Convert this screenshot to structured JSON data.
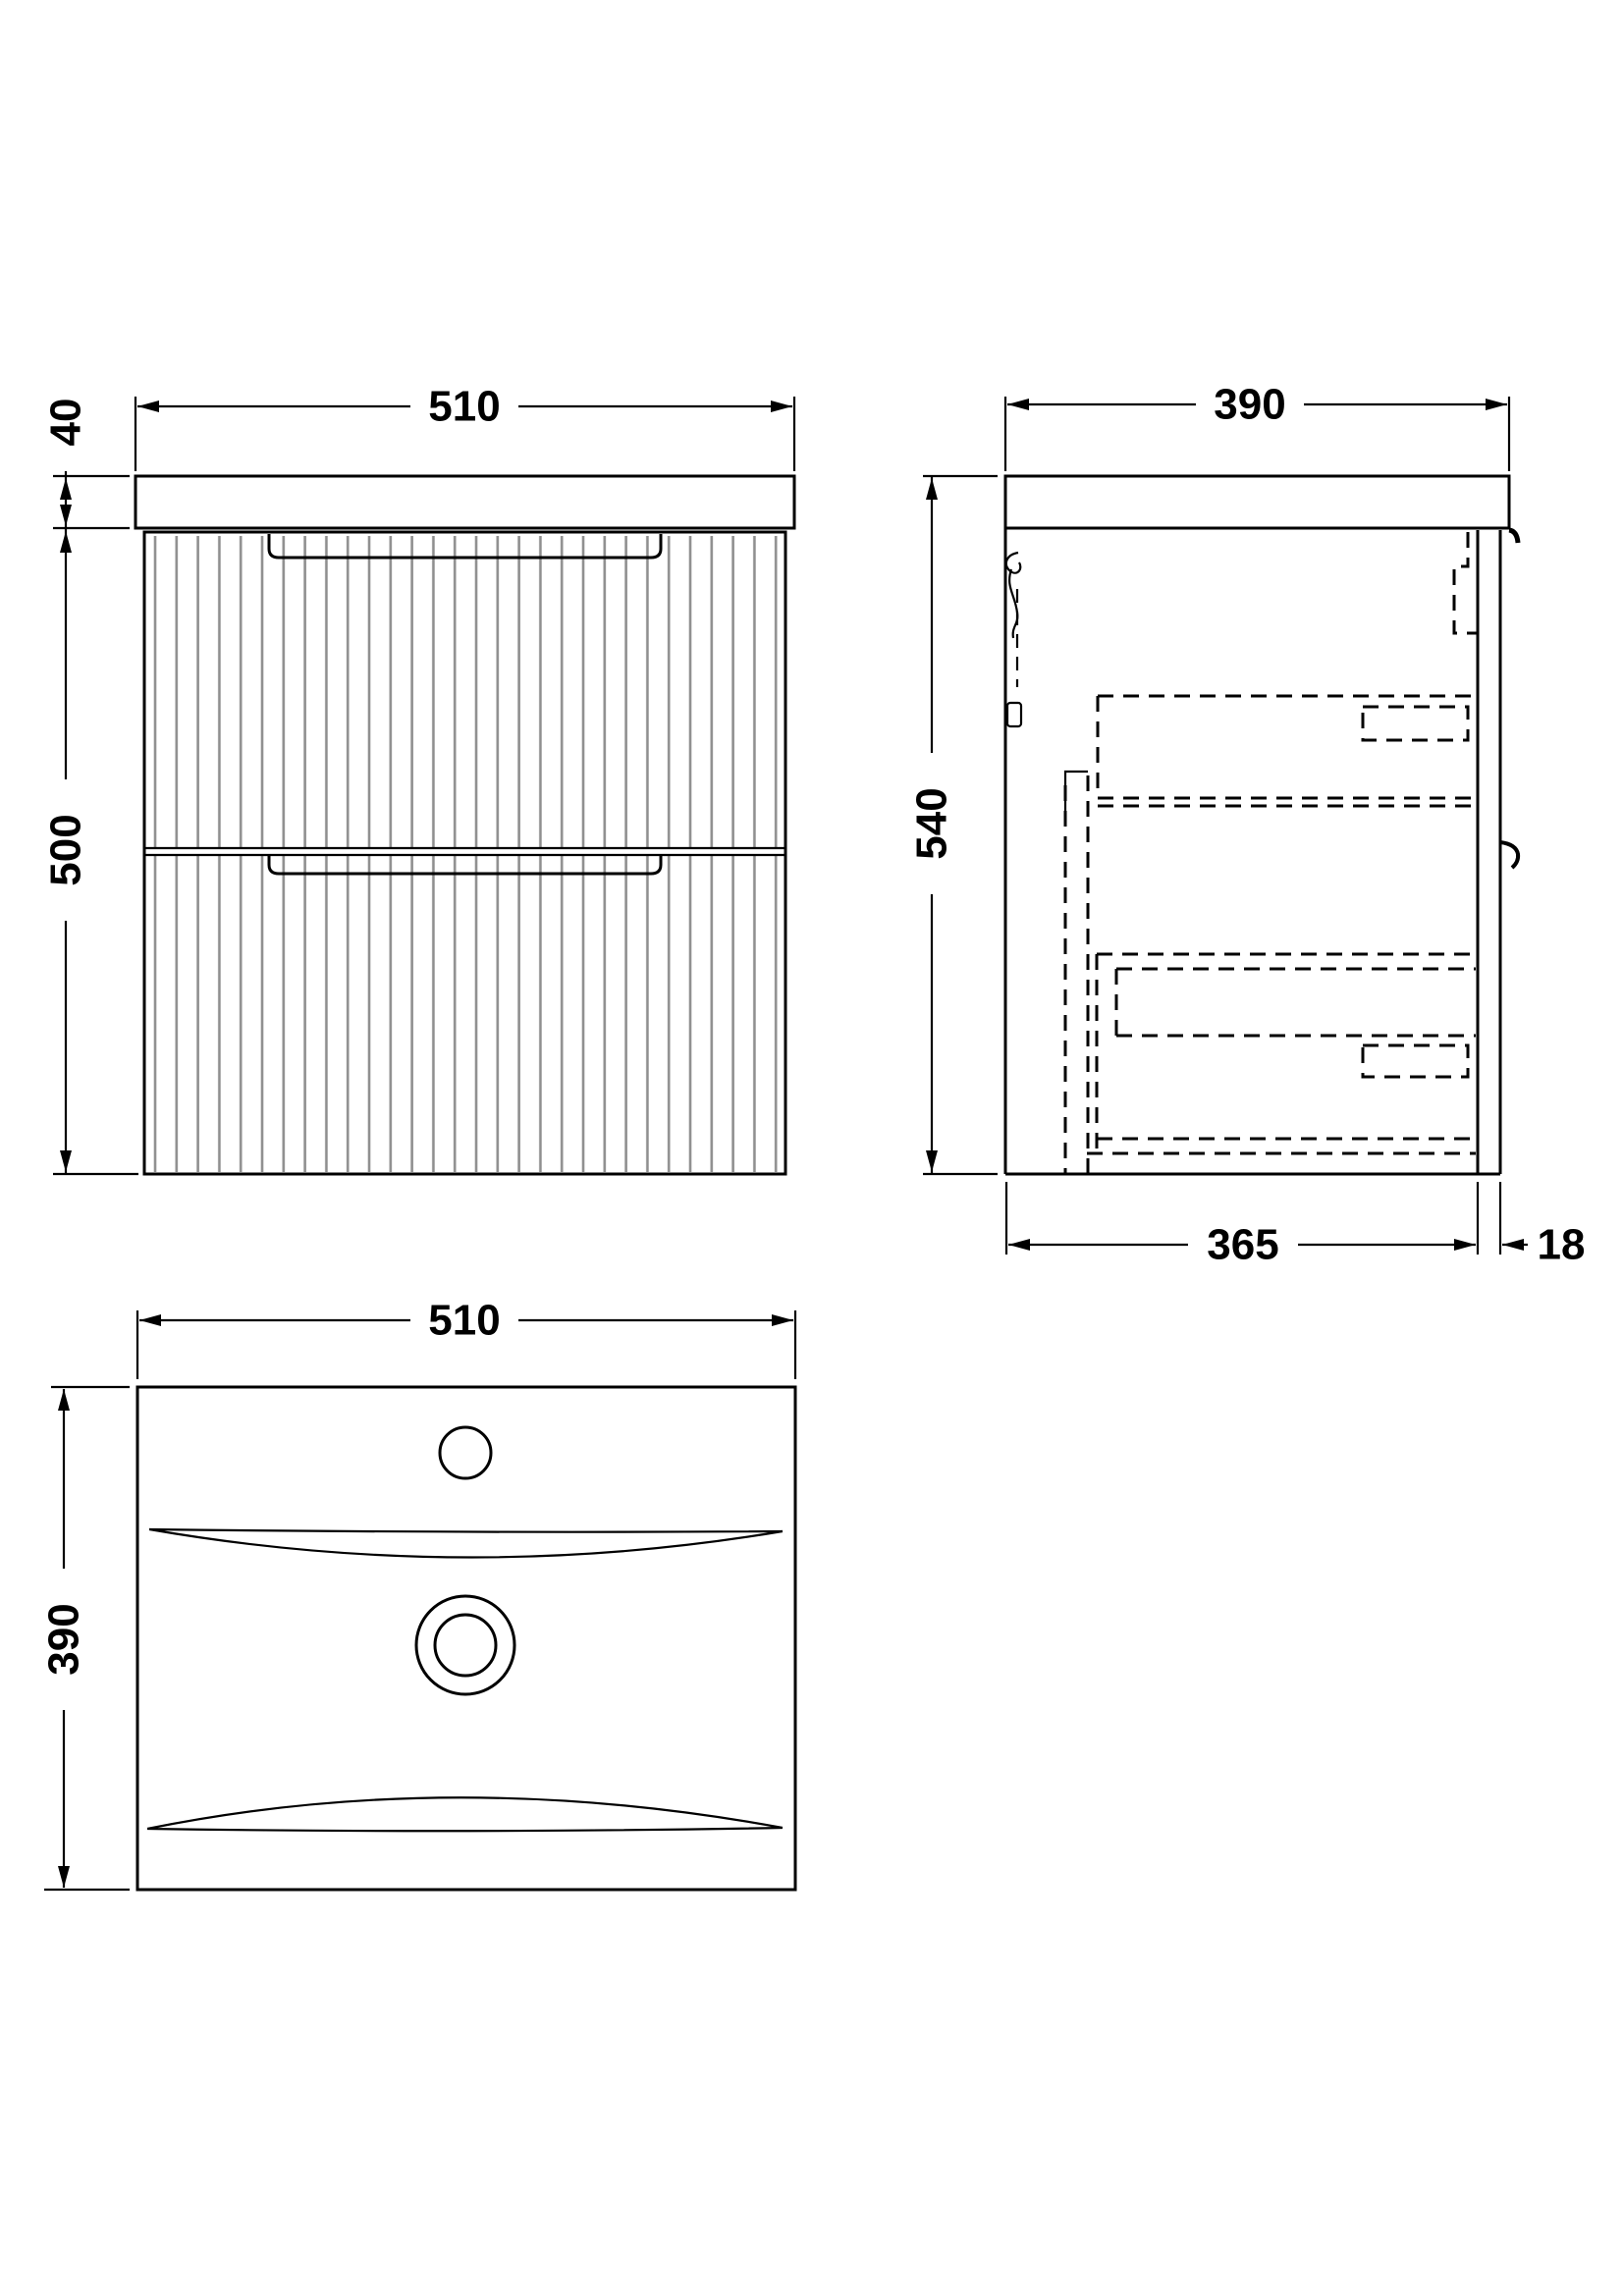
{
  "drawing": {
    "type": "technical-dimension-drawing",
    "subject": "wall-hung-two-drawer-fluted-vanity-unit-with-basin",
    "colors": {
      "line": "#000000",
      "flute": "#8f8f8f",
      "background": "#ffffff"
    },
    "views": {
      "front": {
        "label": "front-view",
        "width_mm": "510",
        "basin_height_mm": "40",
        "cabinet_height_mm": "500"
      },
      "side": {
        "label": "side-view",
        "depth_mm": "390",
        "overall_height_mm": "540",
        "cabinet_depth_mm": "365",
        "front_panel_mm": "18"
      },
      "plan": {
        "label": "basin-plan-view",
        "width_mm": "510",
        "depth_mm": "390"
      }
    }
  }
}
